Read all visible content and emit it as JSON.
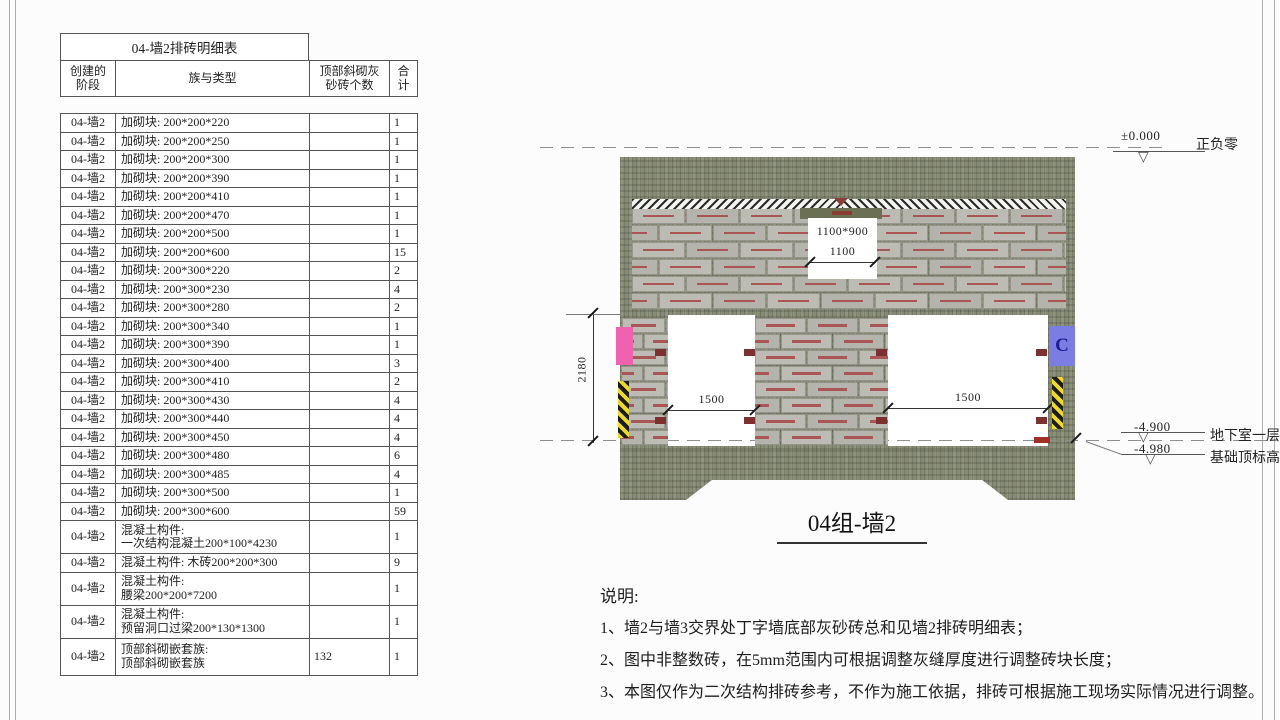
{
  "colors": {
    "wall_texture": "#878b76",
    "brick": "#bcbbb4",
    "brick_mark": "#a84444",
    "pink_block": "#ef62b0",
    "blue_block": "#7b7de2",
    "hazard_yellow": "#ecd92a",
    "wood_brick": "#7c3030"
  },
  "schedule_table": {
    "title": "04-墙2排砖明细表",
    "columns": [
      [
        "创建的",
        "阶段"
      ],
      [
        "族与类型"
      ],
      [
        "顶部斜砌灰",
        "砂砖个数"
      ],
      [
        "合",
        "计"
      ]
    ],
    "rows": [
      [
        "04-墙2",
        [
          "加砌块: 200*200*220"
        ],
        "",
        "1"
      ],
      [
        "04-墙2",
        [
          "加砌块: 200*200*250"
        ],
        "",
        "1"
      ],
      [
        "04-墙2",
        [
          "加砌块: 200*200*300"
        ],
        "",
        "1"
      ],
      [
        "04-墙2",
        [
          "加砌块: 200*200*390"
        ],
        "",
        "1"
      ],
      [
        "04-墙2",
        [
          "加砌块: 200*200*410"
        ],
        "",
        "1"
      ],
      [
        "04-墙2",
        [
          "加砌块: 200*200*470"
        ],
        "",
        "1"
      ],
      [
        "04-墙2",
        [
          "加砌块: 200*200*500"
        ],
        "",
        "1"
      ],
      [
        "04-墙2",
        [
          "加砌块: 200*200*600"
        ],
        "",
        "15"
      ],
      [
        "04-墙2",
        [
          "加砌块: 200*300*220"
        ],
        "",
        "2"
      ],
      [
        "04-墙2",
        [
          "加砌块: 200*300*230"
        ],
        "",
        "4"
      ],
      [
        "04-墙2",
        [
          "加砌块: 200*300*280"
        ],
        "",
        "2"
      ],
      [
        "04-墙2",
        [
          "加砌块: 200*300*340"
        ],
        "",
        "1"
      ],
      [
        "04-墙2",
        [
          "加砌块: 200*300*390"
        ],
        "",
        "1"
      ],
      [
        "04-墙2",
        [
          "加砌块: 200*300*400"
        ],
        "",
        "3"
      ],
      [
        "04-墙2",
        [
          "加砌块: 200*300*410"
        ],
        "",
        "2"
      ],
      [
        "04-墙2",
        [
          "加砌块: 200*300*430"
        ],
        "",
        "4"
      ],
      [
        "04-墙2",
        [
          "加砌块: 200*300*440"
        ],
        "",
        "4"
      ],
      [
        "04-墙2",
        [
          "加砌块: 200*300*450"
        ],
        "",
        "4"
      ],
      [
        "04-墙2",
        [
          "加砌块: 200*300*480"
        ],
        "",
        "6"
      ],
      [
        "04-墙2",
        [
          "加砌块: 200*300*485"
        ],
        "",
        "4"
      ],
      [
        "04-墙2",
        [
          "加砌块: 200*300*500"
        ],
        "",
        "1"
      ],
      [
        "04-墙2",
        [
          "加砌块: 200*300*600"
        ],
        "",
        "59"
      ],
      [
        "04-墙2",
        [
          "混凝土构件:",
          "一次结构混凝土200*100*4230"
        ],
        "",
        "1"
      ],
      [
        "04-墙2",
        [
          "混凝土构件: 木砖200*200*300"
        ],
        "",
        "9"
      ],
      [
        "04-墙2",
        [
          "混凝土构件:",
          "腰梁200*200*7200"
        ],
        "",
        "1"
      ],
      [
        "04-墙2",
        [
          "混凝土构件:",
          "预留洞口过梁200*130*1300"
        ],
        "",
        "1"
      ],
      [
        "04-墙2",
        [
          "顶部斜砌嵌套族:",
          "顶部斜砌嵌套族"
        ],
        "132",
        "1"
      ]
    ]
  },
  "drawing": {
    "title": "04组-墙2",
    "window_letter": "C",
    "wall_height": "2180",
    "opening_upper": {
      "size": "1100*900",
      "width": "1100"
    },
    "opening_left": {
      "width": "1500"
    },
    "opening_right": {
      "width": "1500"
    },
    "level_top": {
      "value": "±0.000",
      "label": "正负零"
    },
    "level_mid": {
      "value": "-4.900",
      "label": "地下室一层"
    },
    "level_low": {
      "value": "-4.980",
      "label": "基础顶标高"
    }
  },
  "notes": {
    "heading": "说明:",
    "items": [
      "1、墙2与墙3交界处丁字墙底部灰砂砖总和见墙2排砖明细表；",
      "2、图中非整数砖，在5mm范围内可根据调整灰缝厚度进行调整砖块长度；",
      "3、本图仅作为二次结构排砖参考，不作为施工依据，排砖可根据施工现场实际情况进行调整。"
    ]
  }
}
